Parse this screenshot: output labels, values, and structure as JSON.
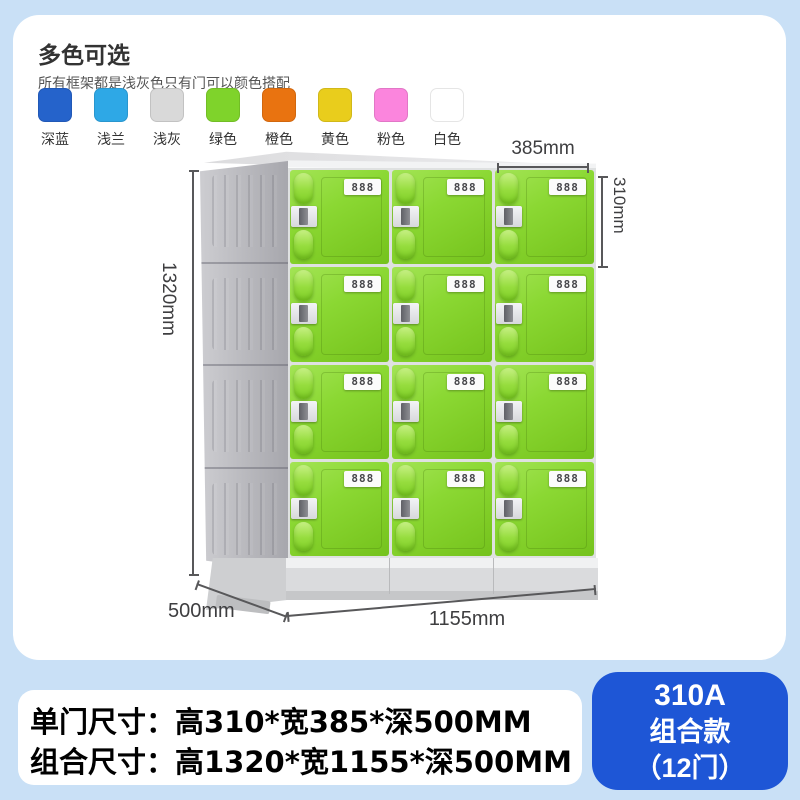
{
  "color_section": {
    "title": "多色可选",
    "subtitle": "所有框架都是浅灰色只有门可以颜色搭配",
    "swatches": [
      {
        "label": "深蓝",
        "color": "#2563cb"
      },
      {
        "label": "浅兰",
        "color": "#2ea8e6"
      },
      {
        "label": "浅灰",
        "color": "#d9d9d9"
      },
      {
        "label": "绿色",
        "color": "#7fd32b"
      },
      {
        "label": "橙色",
        "color": "#e97310"
      },
      {
        "label": "黄色",
        "color": "#e9cd1c"
      },
      {
        "label": "粉色",
        "color": "#fb85dd"
      },
      {
        "label": "白色",
        "color": "#ffffff"
      }
    ]
  },
  "locker": {
    "plate_label": "888",
    "rows": 4,
    "columns": 3,
    "door_color_hex": "#7fd32b",
    "frame_color_hex": "#b4b4b9",
    "dimensions": {
      "door_width": "385mm",
      "door_height": "310mm",
      "total_height": "1320mm",
      "depth": "500mm",
      "total_width": "1155mm"
    }
  },
  "specs": {
    "line1": "单门尺寸：高310*宽385*深500MM",
    "line2": "组合尺寸：高1320*宽1155*深500MM"
  },
  "badge": {
    "model": "310A",
    "series": "组合款",
    "door_count": "（12门）",
    "color": "#1e56d6"
  }
}
